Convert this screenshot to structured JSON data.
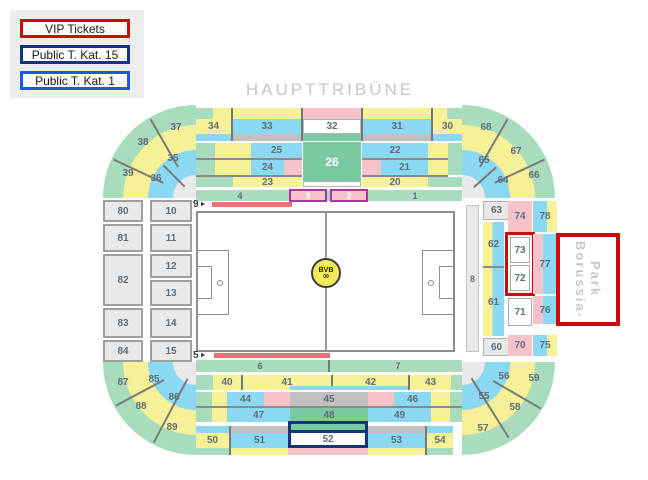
{
  "legend": {
    "items": [
      {
        "label": "VIP Tickets"
      },
      {
        "label": "Public T. Kat. 15"
      },
      {
        "label": "Public T. Kat. 1"
      }
    ]
  },
  "colors": {
    "vip": "#cf0a0a",
    "kat15": "#13357b",
    "kat1": "#1a5ae0"
  },
  "title": "HAUPTTRIBÜNE",
  "venue": {
    "line1": "Borussia-",
    "line2": "Park"
  },
  "pitch_logo": {
    "abbr": "BVB",
    "year": "09"
  },
  "markers": {
    "nine": "9",
    "five": "5",
    "arrow": "►"
  },
  "labels": {
    "s1": "1",
    "s2": "2",
    "s3": "3",
    "s4": "4",
    "s5": "5",
    "s6": "6",
    "s7": "7",
    "s8": "8",
    "s9": "9",
    "s10": "10",
    "s11": "11",
    "s12": "12",
    "s13": "13",
    "s14": "14",
    "s15": "15",
    "s20": "20",
    "s21": "21",
    "s22": "22",
    "s23": "23",
    "s24": "24",
    "s25": "25",
    "s26": "26",
    "s30": "30",
    "s31": "31",
    "s32": "32",
    "s33": "33",
    "s34": "34",
    "s35": "35",
    "s36": "36",
    "s37": "37",
    "s38": "38",
    "s39": "39",
    "s40": "40",
    "s41": "41",
    "s42": "42",
    "s43": "43",
    "s44": "44",
    "s45": "45",
    "s46": "46",
    "s47": "47",
    "s48": "48",
    "s49": "49",
    "s50": "50",
    "s51": "51",
    "s52": "52",
    "s53": "53",
    "s54": "54",
    "s55": "55",
    "s56": "56",
    "s57": "57",
    "s58": "58",
    "s59": "59",
    "s60": "60",
    "s61": "61",
    "s62": "62",
    "s63": "63",
    "s64": "64",
    "s65": "65",
    "s66": "66",
    "s67": "67",
    "s68": "68",
    "s70": "70",
    "s71": "71",
    "s72": "72",
    "s73": "73",
    "s74": "74",
    "s75": "75",
    "s76": "76",
    "s77": "77",
    "s78": "78",
    "s80": "80",
    "s81": "81",
    "s82": "82",
    "s83": "83",
    "s84": "84",
    "s85": "85",
    "s86": "86",
    "s87": "87",
    "s88": "88",
    "s89": "89"
  }
}
